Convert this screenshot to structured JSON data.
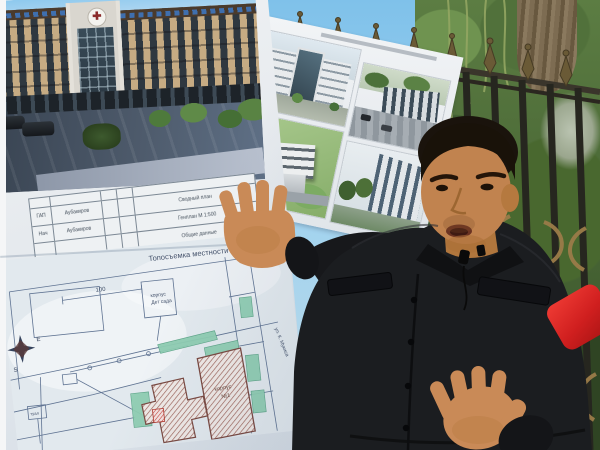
{
  "scene": {
    "description": "Man in black jacket presenting architectural renderings and a site plan on outdoor poster boards in front of a wrought-iron fence and trees"
  },
  "colors": {
    "sky": "#87c6ec",
    "poster_white": "#eef0f2",
    "plan_line": "#5f7392",
    "plan_green": "#8fcdb2",
    "hatch_brown": "#9a5f55",
    "accent_red_mic": "#d01f1f",
    "jacket_black": "#1b1d20",
    "skin": "#c98a57",
    "foliage_green": "#4a6836",
    "fence_brass": "#9b7c49"
  },
  "poster_left": {
    "emblem_glyph": "✚",
    "title_block": {
      "rows": [
        {
          "role": "ГАП",
          "name": "Аубакиров",
          "note": "Сводный план"
        },
        {
          "role": "Нач",
          "name": "Аубакиров",
          "note": "Генплан М 1:500"
        },
        {
          "role": "",
          "name": "",
          "note": "Общие данные"
        }
      ]
    },
    "plan": {
      "title": "Топосъемка местности",
      "dim_100": "100",
      "kindergarten_line1": "корпус",
      "kindergarten_line2": "Дет сада",
      "building_line1": "корпус",
      "building_line2": "№1",
      "toilet_box": "туал",
      "street": "ул. К. Мукиса",
      "compass_e": "Е",
      "compass_s": "S"
    }
  }
}
